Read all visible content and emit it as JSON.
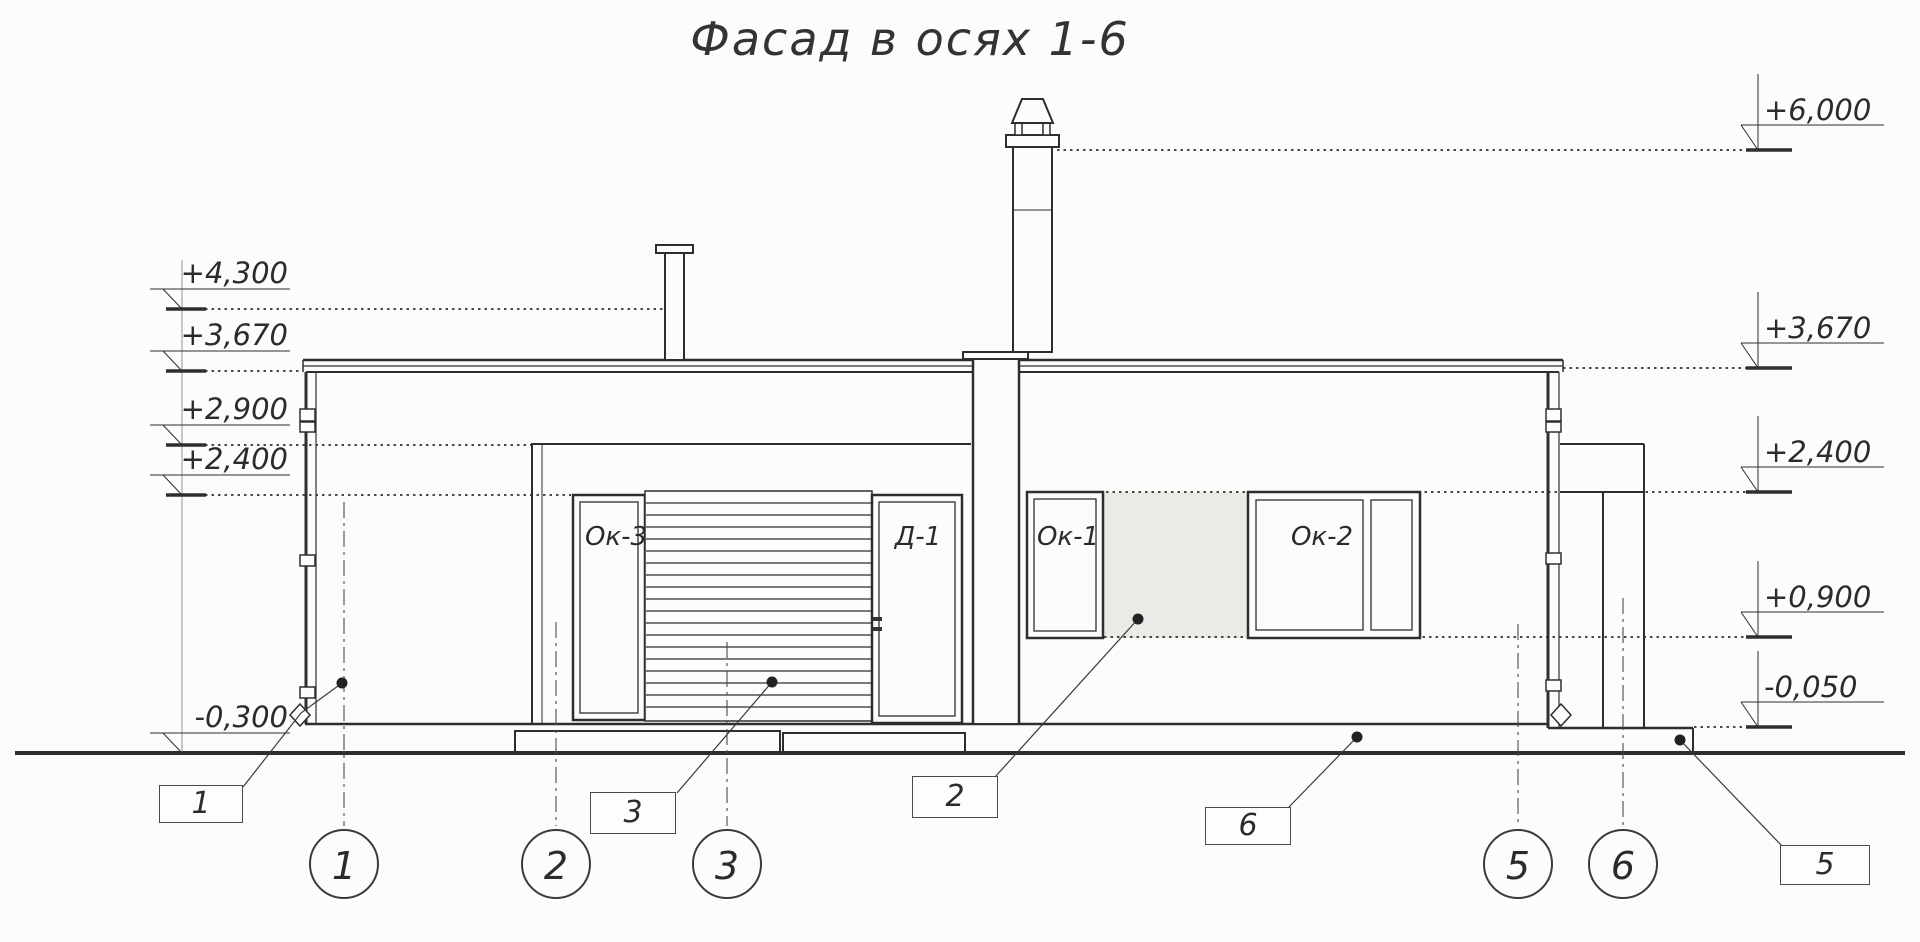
{
  "title": "Фасад в осях 1-6",
  "levels": {
    "left": [
      "+4,300",
      "+3,670",
      "+2,900",
      "+2,400",
      "-0,300"
    ],
    "right": [
      "+6,000",
      "+3,670",
      "+2,400",
      "+0,900",
      "-0,050"
    ]
  },
  "openings": {
    "ok3": "Ок-3",
    "d1": "Д-1",
    "ok1": "Ок-1",
    "ok2": "Ок-2"
  },
  "axes": [
    "1",
    "2",
    "3",
    "5",
    "6"
  ],
  "callouts": [
    "1",
    "3",
    "2",
    "6",
    "5"
  ],
  "colors": {
    "line": "#2e2e2e",
    "panel": "#eaeae7",
    "background": "#fcfcfb"
  }
}
